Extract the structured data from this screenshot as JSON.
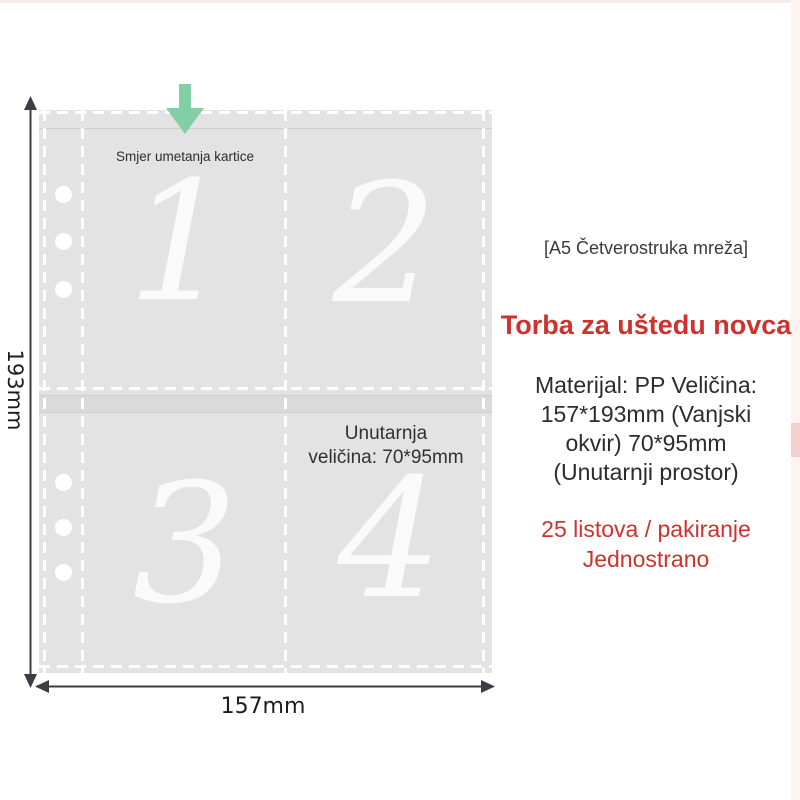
{
  "diagram": {
    "insert_direction_label": "Smjer umetanja kartice",
    "inner_size_lines": [
      "Unutarnja",
      "veličina: 70*95mm"
    ],
    "height_label": "193mm",
    "width_label": "157mm",
    "pocket_numbers": [
      "1",
      "2",
      "3",
      "4"
    ]
  },
  "right_panel": {
    "tag": "[A5 Četverostruka mreža]",
    "title": "Torba za uštedu novca",
    "spec_lines": [
      "Materijal: PP Veličina:",
      "157*193mm (Vanjski",
      "okvir) 70*95mm",
      "(Unutarnji prostor)"
    ],
    "pack_lines": [
      "25 listova / pakiranje",
      "Jednostrano"
    ]
  },
  "colors": {
    "accent_red": "#cd322c",
    "arrow_green": "#83cfa5",
    "sleeve_gray": "#e3e3e3",
    "dash_white": "#ffffff",
    "dimension_dark": "#3c3c44"
  }
}
